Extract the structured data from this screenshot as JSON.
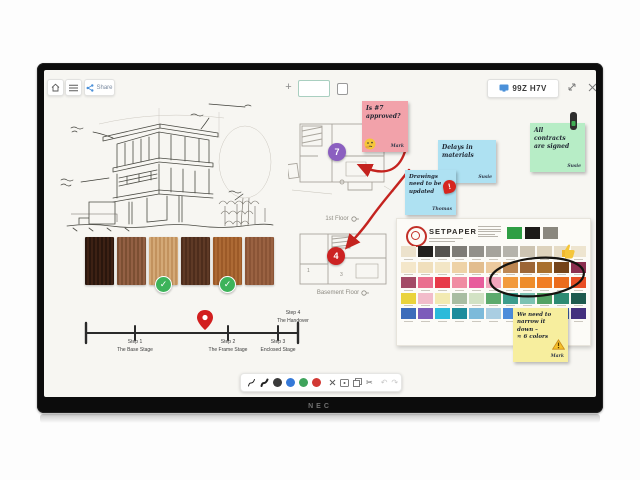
{
  "monitor": {
    "brand": "NEC",
    "session_badge": "99Z H7V"
  },
  "topbar": {
    "share_label": "Share"
  },
  "notes": {
    "pink": {
      "text": "Is #7\napproved?",
      "author": "Mark"
    },
    "blue1": {
      "text": "Delays in\nmaterials",
      "author": "Susie"
    },
    "blue2": {
      "text": "Drawings\nneed to be\nupdated",
      "author": "Thomas"
    },
    "green": {
      "text": "All\ncontracts\nare signed",
      "author": "Susie"
    },
    "yellow": {
      "text": "We need to\nnarrow it\ndown –\n≈ 6 colors",
      "author": "Mark"
    }
  },
  "timeline": {
    "steps": [
      {
        "title": "Step 1",
        "subtitle": "The Base Stage"
      },
      {
        "title": "Step 2",
        "subtitle": "The Frame Stage"
      },
      {
        "title": "Step 3",
        "subtitle": "Enclosed Stage"
      },
      {
        "title": "Step 4",
        "subtitle": "The Handover"
      }
    ]
  },
  "floorplans": {
    "first_label": "1st Floor",
    "basement_label": "Basement Floor",
    "first_badge": "7",
    "basement_badge": "4",
    "basement_rooms": [
      "1",
      "2",
      "3"
    ]
  },
  "palette_card": {
    "title": "SETPAPER",
    "header_swatches": [
      "#2e9e44",
      "#1c1a18",
      "#8a877e"
    ],
    "rows": [
      [
        "#ece2cc",
        "#22201e",
        "#55534f",
        "#7e7c76",
        "#92908a",
        "#a5a39c",
        "#b5b3ab",
        "#cdc4b2",
        "#ddd2bc",
        "#e6dcc6",
        "#eee5d0"
      ],
      [
        "#f4e7ca",
        "#f0dfbc",
        "#f3e6c6",
        "#eed2a6",
        "#e2bd8e",
        "#ecca9e",
        "#bd8651",
        "#9c6636",
        "#a86f2c",
        "#744318",
        "#8c2f50"
      ],
      [
        "#a34a66",
        "#ea6e8e",
        "#e73a48",
        "#f08ca2",
        "#e85c9c",
        "#f2a6bc",
        "#f29a3c",
        "#ee8c2a",
        "#f07d24",
        "#eb6c1c",
        "#e84e24"
      ],
      [
        "#ead33c",
        "#f2bcca",
        "#f2eab2",
        "#a9bda2",
        "#d2e2c4",
        "#5caa6c",
        "#3c9c8c",
        "#7cc2b2",
        "#52a262",
        "#2e8a72",
        "#1e5a4e"
      ],
      [
        "#3c6cba",
        "#7c5cba",
        "#2cbada",
        "#1e8c9c",
        "#7cbada",
        "#aacee2",
        "#4c8cda",
        "#2c4c9c",
        "#5c7cca",
        "#3c5cac",
        "#43307e"
      ]
    ]
  },
  "wood": {
    "swatches": [
      {
        "c1": "#2a160d",
        "c2": "#3d2114"
      },
      {
        "c1": "#7c4f33",
        "c2": "#936044"
      },
      {
        "c1": "#d4a977",
        "c2": "#c2925e"
      },
      {
        "c1": "#4e2d1c",
        "c2": "#5f3a26"
      },
      {
        "c1": "#9c5a28",
        "c2": "#ad6a35"
      },
      {
        "c1": "#8a5436",
        "c2": "#9a6242"
      }
    ],
    "approved_indexes": [
      2,
      4
    ]
  },
  "bottom_toolbar": {
    "pen_colors": [
      "#3a3a3a",
      "#3579d8",
      "#3fa45c",
      "#d23934"
    ]
  },
  "accents": {
    "arrow_red": "#c4231f",
    "badge_purple": "#8b5fc0",
    "badge_red": "#cc2222"
  }
}
